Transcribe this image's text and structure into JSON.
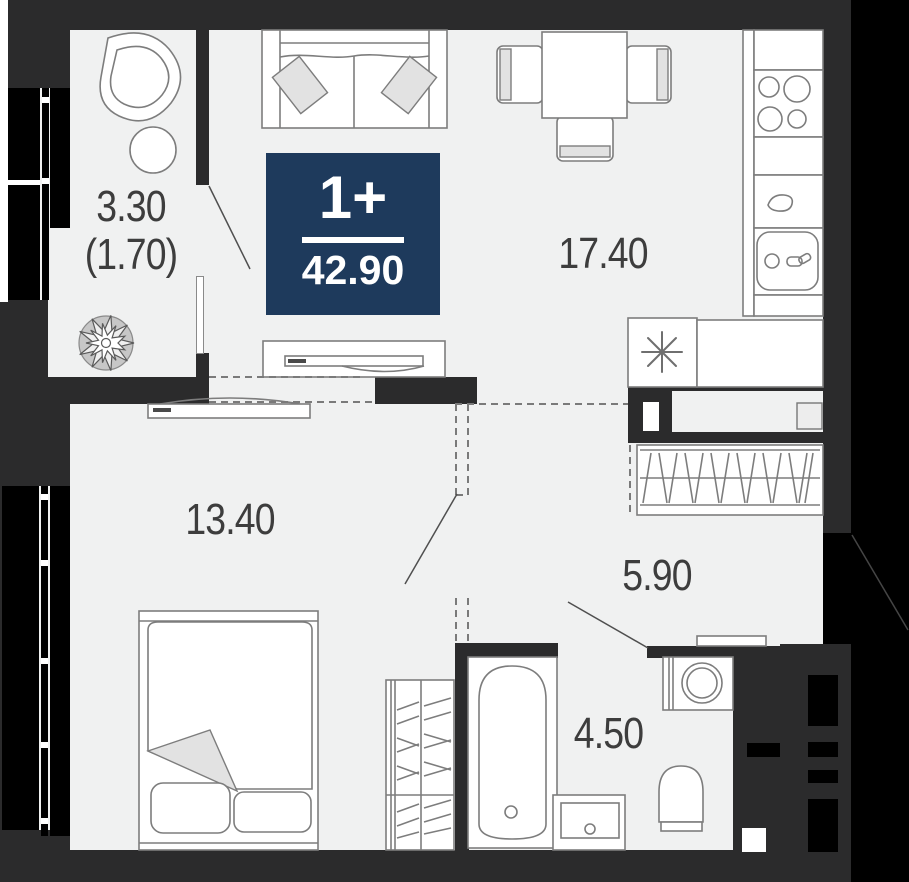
{
  "floor_plan": {
    "badge": {
      "rooms_label": "1+",
      "total_area": "42.90"
    },
    "rooms": [
      {
        "id": "balcony",
        "area": "3.30",
        "area_secondary": "(1.70)"
      },
      {
        "id": "kitchen-living",
        "area": "17.40"
      },
      {
        "id": "bedroom",
        "area": "13.40"
      },
      {
        "id": "hallway",
        "area": "5.90"
      },
      {
        "id": "bathroom",
        "area": "4.50"
      }
    ],
    "colors": {
      "wall": "#2b2b2c",
      "window": "#000000",
      "floor": "#f0f1f1",
      "badge_bg": "#1e3a5c",
      "badge_text": "#ffffff",
      "label_text": "#3d3d3d",
      "furniture_outline": "#7d7d7d",
      "furniture_accent": "#e2e2e2"
    },
    "icons": [
      "sofa",
      "pillow",
      "dining-table",
      "dining-chair",
      "kitchen-counter",
      "cooktop-icon",
      "kitchen-sink-icon",
      "faucet-icon",
      "appliance-asterisk-icon",
      "tv-console",
      "hanging-chair",
      "coffee-table",
      "plant-icon",
      "wardrobe",
      "bed",
      "bathtub",
      "bathroom-sink",
      "toilet",
      "washing-machine",
      "door-swing-line",
      "zone-dashed-line",
      "vent-shaft",
      "window"
    ]
  }
}
